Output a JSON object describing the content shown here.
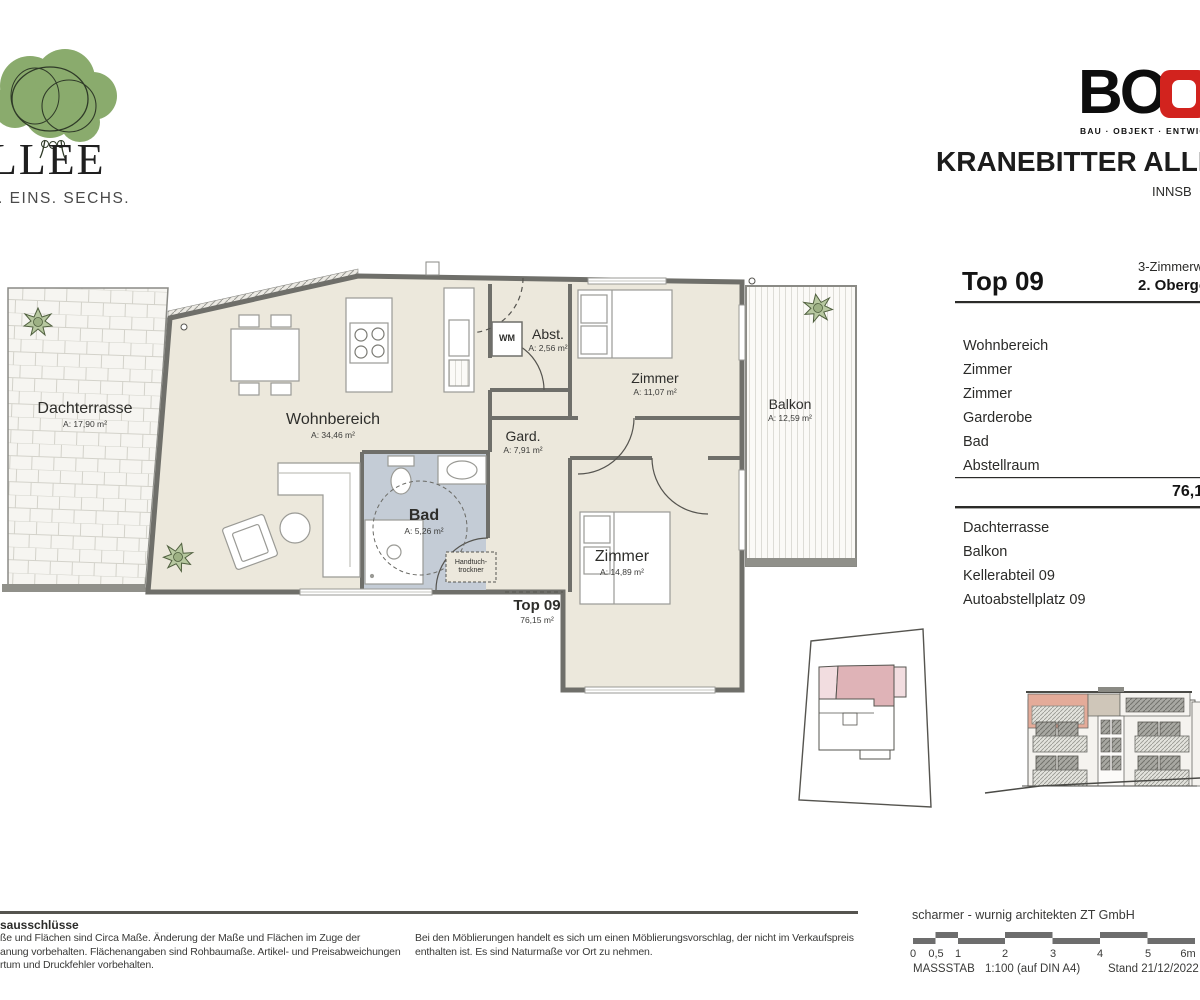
{
  "header": {
    "brand": {
      "name": "LLEE",
      "tagline": ". EINS. SECHS."
    },
    "boe": {
      "letters": "BO",
      "tagline": "BAU · OBJEKT · ENTWIC"
    },
    "project": {
      "title": "KRANEBITTER ALLEE",
      "city": "INNSB"
    }
  },
  "plan": {
    "rooms": {
      "dachterrasse": {
        "label": "Dachterrasse",
        "area": "A: 17,90 m²"
      },
      "wohnbereich": {
        "label": "Wohnbereich",
        "area": "A: 34,46 m²"
      },
      "abst": {
        "label": "Abst.",
        "area": "A: 2,56 m²"
      },
      "zimmer1": {
        "label": "Zimmer",
        "area": "A: 11,07 m²"
      },
      "gard": {
        "label": "Gard.",
        "area": "A: 7,91 m²"
      },
      "bad": {
        "label": "Bad",
        "area": "A: 5,26 m²"
      },
      "zimmer2": {
        "label": "Zimmer",
        "area": "A: 14,89 m²"
      },
      "balkon": {
        "label": "Balkon",
        "area": "A: 12,59 m²"
      }
    },
    "wm": "WM",
    "handtuch": {
      "line1": "Handtuch-",
      "line2": "trockner"
    },
    "unit": {
      "title": "Top 09",
      "area": "76,15 m²"
    }
  },
  "panel": {
    "unit": "Top 09",
    "type_fragment": "3-Zimmerw",
    "floor_fragment": "2. Oberge",
    "rooms": [
      "Wohnbereich",
      "Zimmer",
      "Zimmer",
      "Garderobe",
      "Bad",
      "Abstellraum"
    ],
    "total_fragment": "76,1",
    "extras": [
      "Dachterrasse",
      "Balkon",
      "Kellerabteil 09",
      "Autoabstellplatz 09"
    ]
  },
  "footer": {
    "left": {
      "title": "sausschlüsse",
      "lines": [
        "ße und Flächen sind Circa Maße. Änderung der Maße und Flächen im Zuge der",
        "anung vorbehalten. Flächenangaben sind Rohbaumaße. Artikel- und Preisabweichungen",
        "rtum und Druckfehler vorbehalten."
      ]
    },
    "middle": {
      "lines": [
        "Bei den Möblierungen handelt es sich um einen Möblierungsvorschlag, der nicht im Verkaufspreis",
        "enthalten ist. Es sind Naturmaße vor Ort zu nehmen."
      ]
    },
    "architect": "scharmer - wurnig architekten ZT GmbH",
    "scale": {
      "ticks": [
        "0",
        "0,5",
        "1",
        "2",
        "3",
        "4",
        "5",
        "6m"
      ],
      "label": "MASSSTAB",
      "value": "1:100 (auf DIN A4)",
      "date": "Stand 21/12/2022"
    }
  },
  "colors": {
    "logo_green": "#8aab6d",
    "boe_red": "#d2231e",
    "plan_floor": "#ece8dc",
    "bad_floor": "#c4ccd6",
    "wall": "#6f6f6a",
    "pink_dark": "#dfb3b7",
    "pink_light": "#f2dde0",
    "salmon": "#e4ab99"
  }
}
